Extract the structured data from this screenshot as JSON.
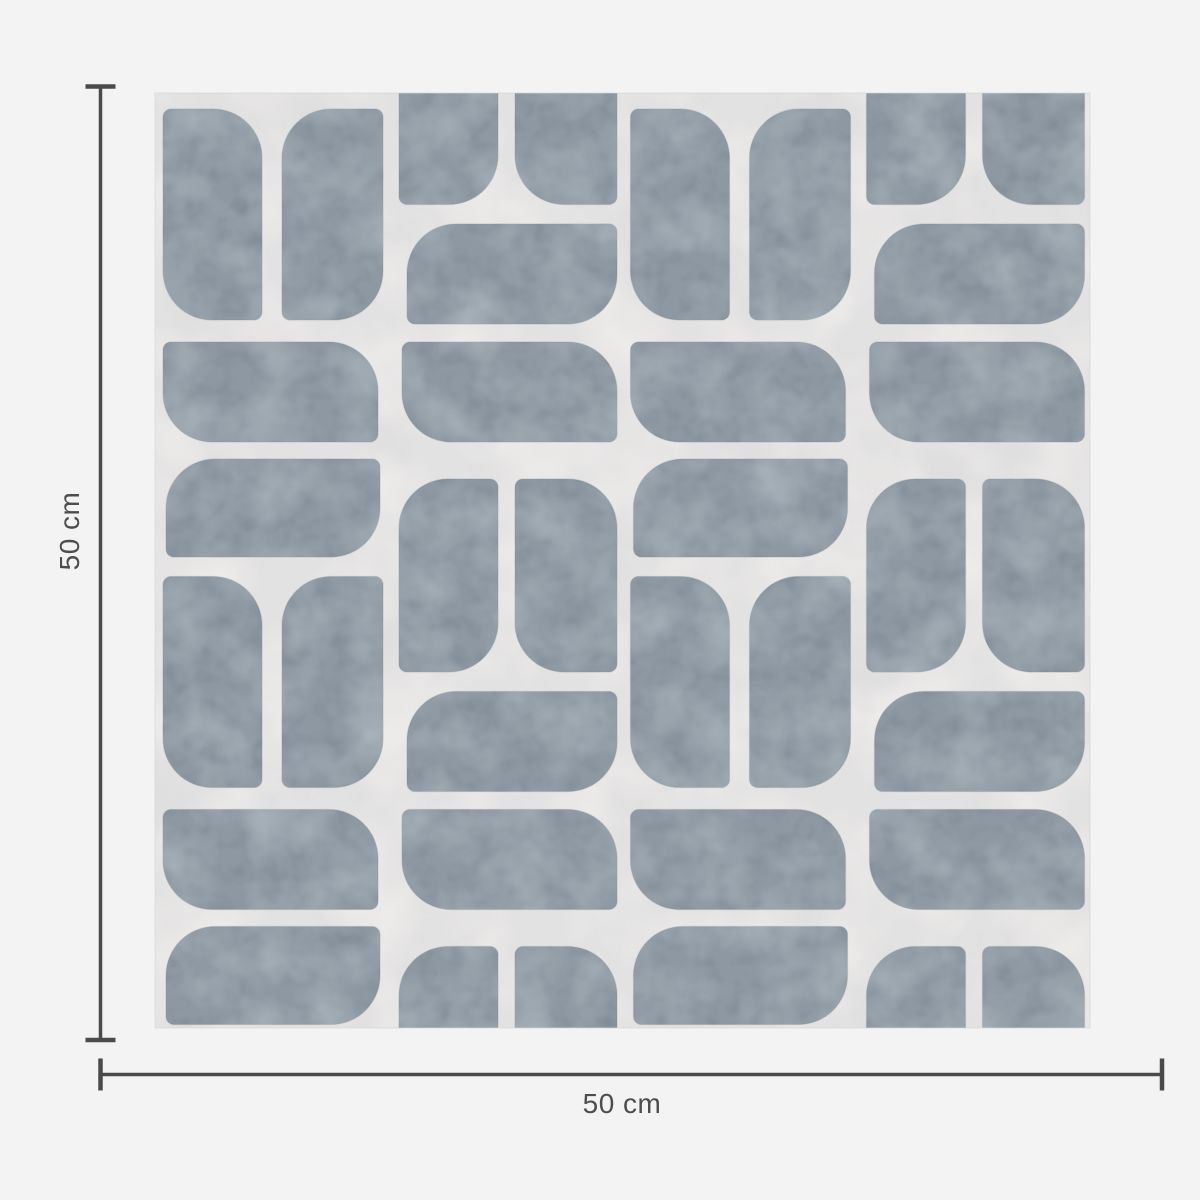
{
  "page": {
    "background_color": "#f4f3f4"
  },
  "diagram": {
    "tile": {
      "x": 155,
      "y": 93,
      "width": 935,
      "height": 935,
      "background_color": "#e3e2e2",
      "border_color": "#d6d5d5",
      "shape_color": "#8e98a2",
      "shape_edge_color": "#76828c",
      "texture_light_color": "#b3bdc4",
      "texture_dark_color": "#758591",
      "pattern_origin": {
        "x": 155,
        "y": 95
      },
      "pattern_unit": {
        "size": 467.5,
        "big_radius": 49,
        "small_radius": 8,
        "shapes": [
          {
            "name": "tall-left",
            "x": 8,
            "y": 14,
            "w": 99,
            "h": 211,
            "round": "tr-bl"
          },
          {
            "name": "tall-right",
            "x": 127,
            "y": 14,
            "w": 101,
            "h": 211,
            "round": "tl-br"
          },
          {
            "name": "wide-left-upper",
            "x": 8,
            "y": 247,
            "w": 215,
            "h": 100,
            "round": "tr-bl"
          },
          {
            "name": "wide-left-lower",
            "x": 11,
            "y": 364,
            "w": 214,
            "h": 98,
            "round": "tl-br"
          },
          {
            "name": "wide-right-upper",
            "x": 252,
            "y": 129,
            "w": 210,
            "h": 100,
            "round": "tl-br"
          },
          {
            "name": "wide-right-lower",
            "x": 247,
            "y": 247,
            "w": 215,
            "h": 100,
            "round": "tr-bl"
          },
          {
            "name": "pair-left",
            "x": 244,
            "y": 384,
            "w": 99,
            "h": 193,
            "round": "tl-br",
            "wrap_y": true
          },
          {
            "name": "pair-right",
            "x": 360,
            "y": 384,
            "w": 102,
            "h": 193,
            "round": "tr-bl",
            "wrap_y": true
          }
        ]
      }
    },
    "dimensions": {
      "height_label": "50 cm",
      "width_label": "50 cm",
      "line_color": "#4a4a4a",
      "label_color": "#4d4d4d",
      "height_line": {
        "x": 100.5,
        "y1": 86.5,
        "y2": 1040,
        "cap_half_length": 15,
        "line_width": 3.5,
        "cap_width": 4.5,
        "label_cx": 69,
        "label_cy": 531
      },
      "width_line": {
        "y": 1074.5,
        "x1": 100.5,
        "x2": 1162,
        "cap_half_length": 16,
        "line_width": 3.5,
        "cap_width": 4.5,
        "label_cx": 622,
        "label_cy": 1103
      }
    }
  }
}
